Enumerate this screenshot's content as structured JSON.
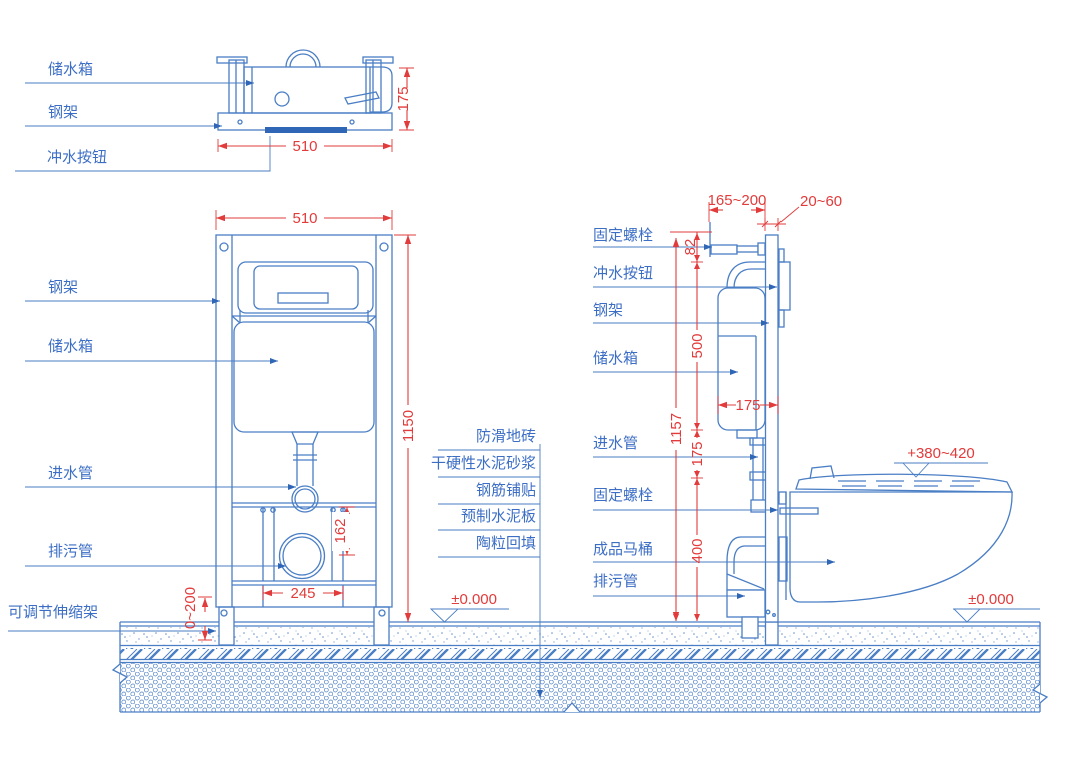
{
  "colors": {
    "line_blue": "#4a7ec5",
    "arrow_blue": "#2f66b5",
    "text_blue": "#3c6ec5",
    "dim_red": "#e23b3b",
    "background": "#ffffff"
  },
  "top_view": {
    "labels": {
      "tank": "储水箱",
      "frame": "钢架",
      "button": "冲水按钮"
    },
    "dims": {
      "depth": "175",
      "width": "510"
    }
  },
  "front_view": {
    "labels": {
      "frame": "钢架",
      "tank": "储水箱",
      "inlet": "进水管",
      "drain": "排污管",
      "telescopic": "可调节伸缩架"
    },
    "dims": {
      "width": "510",
      "height": "1150",
      "drain_offset": "162",
      "drain_span": "245",
      "adjust_range": "0~200"
    }
  },
  "floor": {
    "layers": [
      "防滑地砖",
      "干硬性水泥砂浆",
      "钢筋铺贴",
      "预制水泥板",
      "陶粒回填"
    ],
    "level": "±0.000"
  },
  "side_view": {
    "labels": {
      "bolt_top": "固定螺栓",
      "flush_button": "冲水按钮",
      "frame": "钢架",
      "tank": "储水箱",
      "inlet": "进水管",
      "bolt": "固定螺栓",
      "toilet": "成品马桶",
      "drain": "排污管"
    },
    "dims": {
      "offset_range": "165~200",
      "finish_range": "20~60",
      "top": "82",
      "tank_height": "500",
      "total_height": "1157",
      "tank_width": "175",
      "mid": "175",
      "bottom": "400",
      "seat_level": "+380~420",
      "floor_level": "±0.000"
    }
  }
}
